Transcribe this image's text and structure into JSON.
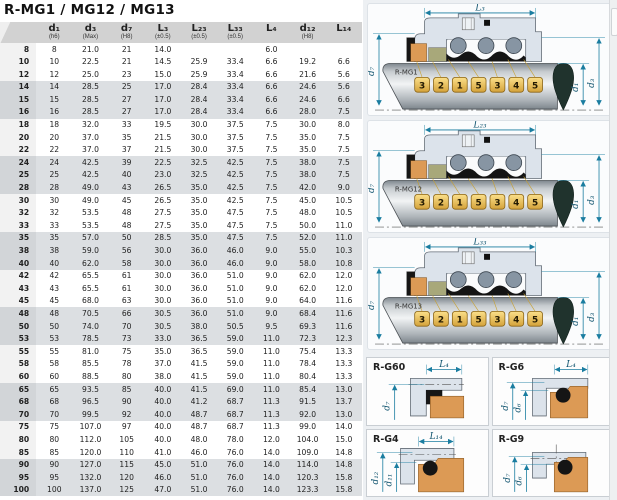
{
  "title": "R-MG1 / MG12 / MG13",
  "table": {
    "headers": [
      "",
      "d₁",
      "d₃",
      "d₇",
      "L₃",
      "L₂₃",
      "L₃₃",
      "L₄",
      "d₁₂",
      "L₁₄"
    ],
    "subheaders": [
      "",
      "(h6)",
      "(Max)",
      "(H8)",
      "(±0.5)",
      "(±0.5)",
      "(±0.5)",
      "",
      "(H8)",
      ""
    ],
    "rows": [
      [
        "8",
        "8",
        "21.0",
        "21",
        "14.0",
        "",
        "",
        "6.0",
        "",
        ""
      ],
      [
        "10",
        "10",
        "22.5",
        "21",
        "14.5",
        "25.9",
        "33.4",
        "6.6",
        "19.2",
        "6.6"
      ],
      [
        "12",
        "12",
        "25.0",
        "23",
        "15.0",
        "25.9",
        "33.4",
        "6.6",
        "21.6",
        "5.6"
      ],
      [
        "14",
        "14",
        "28.5",
        "25",
        "17.0",
        "28.4",
        "33.4",
        "6.6",
        "24.6",
        "5.6"
      ],
      [
        "15",
        "15",
        "28.5",
        "27",
        "17.0",
        "28.4",
        "33.4",
        "6.6",
        "24.6",
        "6.6"
      ],
      [
        "16",
        "16",
        "28.5",
        "27",
        "17.0",
        "28.4",
        "33.4",
        "6.6",
        "28.0",
        "7.5"
      ],
      [
        "18",
        "18",
        "32.0",
        "33",
        "19.5",
        "30.0",
        "37.5",
        "7.5",
        "30.0",
        "8.0"
      ],
      [
        "20",
        "20",
        "37.0",
        "35",
        "21.5",
        "30.0",
        "37.5",
        "7.5",
        "35.0",
        "7.5"
      ],
      [
        "22",
        "22",
        "37.0",
        "37",
        "21.5",
        "30.0",
        "37.5",
        "7.5",
        "35.0",
        "7.5"
      ],
      [
        "24",
        "24",
        "42.5",
        "39",
        "22.5",
        "32.5",
        "42.5",
        "7.5",
        "38.0",
        "7.5"
      ],
      [
        "25",
        "25",
        "42.5",
        "40",
        "23.0",
        "32.5",
        "42.5",
        "7.5",
        "38.0",
        "7.5"
      ],
      [
        "28",
        "28",
        "49.0",
        "43",
        "26.5",
        "35.0",
        "42.5",
        "7.5",
        "42.0",
        "9.0"
      ],
      [
        "30",
        "30",
        "49.0",
        "45",
        "26.5",
        "35.0",
        "42.5",
        "7.5",
        "45.0",
        "10.5"
      ],
      [
        "32",
        "32",
        "53.5",
        "48",
        "27.5",
        "35.0",
        "47.5",
        "7.5",
        "48.0",
        "10.5"
      ],
      [
        "33",
        "33",
        "53.5",
        "48",
        "27.5",
        "35.0",
        "47.5",
        "7.5",
        "50.0",
        "11.0"
      ],
      [
        "35",
        "35",
        "57.0",
        "50",
        "28.5",
        "35.0",
        "47.5",
        "7.5",
        "52.0",
        "11.0"
      ],
      [
        "38",
        "38",
        "59.0",
        "56",
        "30.0",
        "36.0",
        "46.0",
        "9.0",
        "55.0",
        "10.3"
      ],
      [
        "40",
        "40",
        "62.0",
        "58",
        "30.0",
        "36.0",
        "46.0",
        "9.0",
        "58.0",
        "10.8"
      ],
      [
        "42",
        "42",
        "65.5",
        "61",
        "30.0",
        "36.0",
        "51.0",
        "9.0",
        "62.0",
        "12.0"
      ],
      [
        "43",
        "43",
        "65.5",
        "61",
        "30.0",
        "36.0",
        "51.0",
        "9.0",
        "62.0",
        "12.0"
      ],
      [
        "45",
        "45",
        "68.0",
        "63",
        "30.0",
        "36.0",
        "51.0",
        "9.0",
        "64.0",
        "11.6"
      ],
      [
        "48",
        "48",
        "70.5",
        "66",
        "30.5",
        "36.0",
        "51.0",
        "9.0",
        "68.4",
        "11.6"
      ],
      [
        "50",
        "50",
        "74.0",
        "70",
        "30.5",
        "38.0",
        "50.5",
        "9.5",
        "69.3",
        "11.6"
      ],
      [
        "53",
        "53",
        "78.5",
        "73",
        "33.0",
        "36.5",
        "59.0",
        "11.0",
        "72.3",
        "12.3"
      ],
      [
        "55",
        "55",
        "81.0",
        "75",
        "35.0",
        "36.5",
        "59.0",
        "11.0",
        "75.4",
        "13.3"
      ],
      [
        "58",
        "58",
        "85.5",
        "78",
        "37.0",
        "41.5",
        "59.0",
        "11.0",
        "78.4",
        "13.3"
      ],
      [
        "60",
        "60",
        "88.5",
        "80",
        "38.0",
        "41.5",
        "59.0",
        "11.0",
        "80.4",
        "13.3"
      ],
      [
        "65",
        "65",
        "93.5",
        "85",
        "40.0",
        "41.5",
        "69.0",
        "11.0",
        "85.4",
        "13.0"
      ],
      [
        "68",
        "68",
        "96.5",
        "90",
        "40.0",
        "41.2",
        "68.7",
        "11.3",
        "91.5",
        "13.7"
      ],
      [
        "70",
        "70",
        "99.5",
        "92",
        "40.0",
        "48.7",
        "68.7",
        "11.3",
        "92.0",
        "13.0"
      ],
      [
        "75",
        "75",
        "107.0",
        "97",
        "40.0",
        "48.7",
        "68.7",
        "11.3",
        "99.0",
        "14.0"
      ],
      [
        "80",
        "80",
        "112.0",
        "105",
        "40.0",
        "48.0",
        "78.0",
        "12.0",
        "104.0",
        "15.0"
      ],
      [
        "85",
        "85",
        "120.0",
        "110",
        "41.0",
        "46.0",
        "76.0",
        "14.0",
        "109.0",
        "14.8"
      ],
      [
        "90",
        "90",
        "127.0",
        "115",
        "45.0",
        "51.0",
        "76.0",
        "14.0",
        "114.0",
        "14.8"
      ],
      [
        "95",
        "95",
        "132.0",
        "120",
        "46.0",
        "51.0",
        "76.0",
        "14.0",
        "120.3",
        "15.8"
      ],
      [
        "100",
        "100",
        "137.0",
        "125",
        "47.0",
        "51.0",
        "76.0",
        "14.0",
        "123.3",
        "15.8"
      ]
    ]
  },
  "diagrams": {
    "big": [
      {
        "label": "R-MG1",
        "top_dim": "L₃",
        "left_dim": "d₇",
        "right_dim_inner": "d₁",
        "right_dim_outer": "d₃",
        "callouts": [
          "3",
          "2",
          "1",
          "5",
          "3",
          "4",
          "5"
        ]
      },
      {
        "label": "R-MG12",
        "top_dim": "L₂₃",
        "left_dim": "d₇",
        "right_dim_inner": "d₁",
        "right_dim_outer": "d₃",
        "callouts": [
          "3",
          "2",
          "1",
          "5",
          "3",
          "4",
          "5"
        ]
      },
      {
        "label": "R-MG13",
        "top_dim": "L₃₃",
        "left_dim": "d₇",
        "right_dim_inner": "d₁",
        "right_dim_outer": "d₃",
        "callouts": [
          "3",
          "2",
          "1",
          "5",
          "3",
          "4",
          "5"
        ]
      }
    ],
    "small": [
      {
        "label": "R-G60",
        "top_dim": "L₄",
        "dims": [
          "d₇"
        ]
      },
      {
        "label": "R-G6",
        "top_dim": "L₄",
        "dims": [
          "d₇",
          "d₆"
        ]
      },
      {
        "label": "R-G4",
        "top_dim": "L₁₄",
        "dims": [
          "d₁₂",
          "d₁₁"
        ]
      },
      {
        "label": "R-G9",
        "top_dim": "",
        "dims": [
          "d₇",
          "d₆"
        ]
      }
    ]
  },
  "colors": {
    "dim_teal": "#1a7da0",
    "callout_gold": "#d9a940",
    "housing_blue": "#dce3eb",
    "seal_orange": "#dc9a55",
    "seal_khaki": "#a8a87a",
    "band_gray": "#dcdfe2",
    "header_gray": "#d2d2d2"
  }
}
